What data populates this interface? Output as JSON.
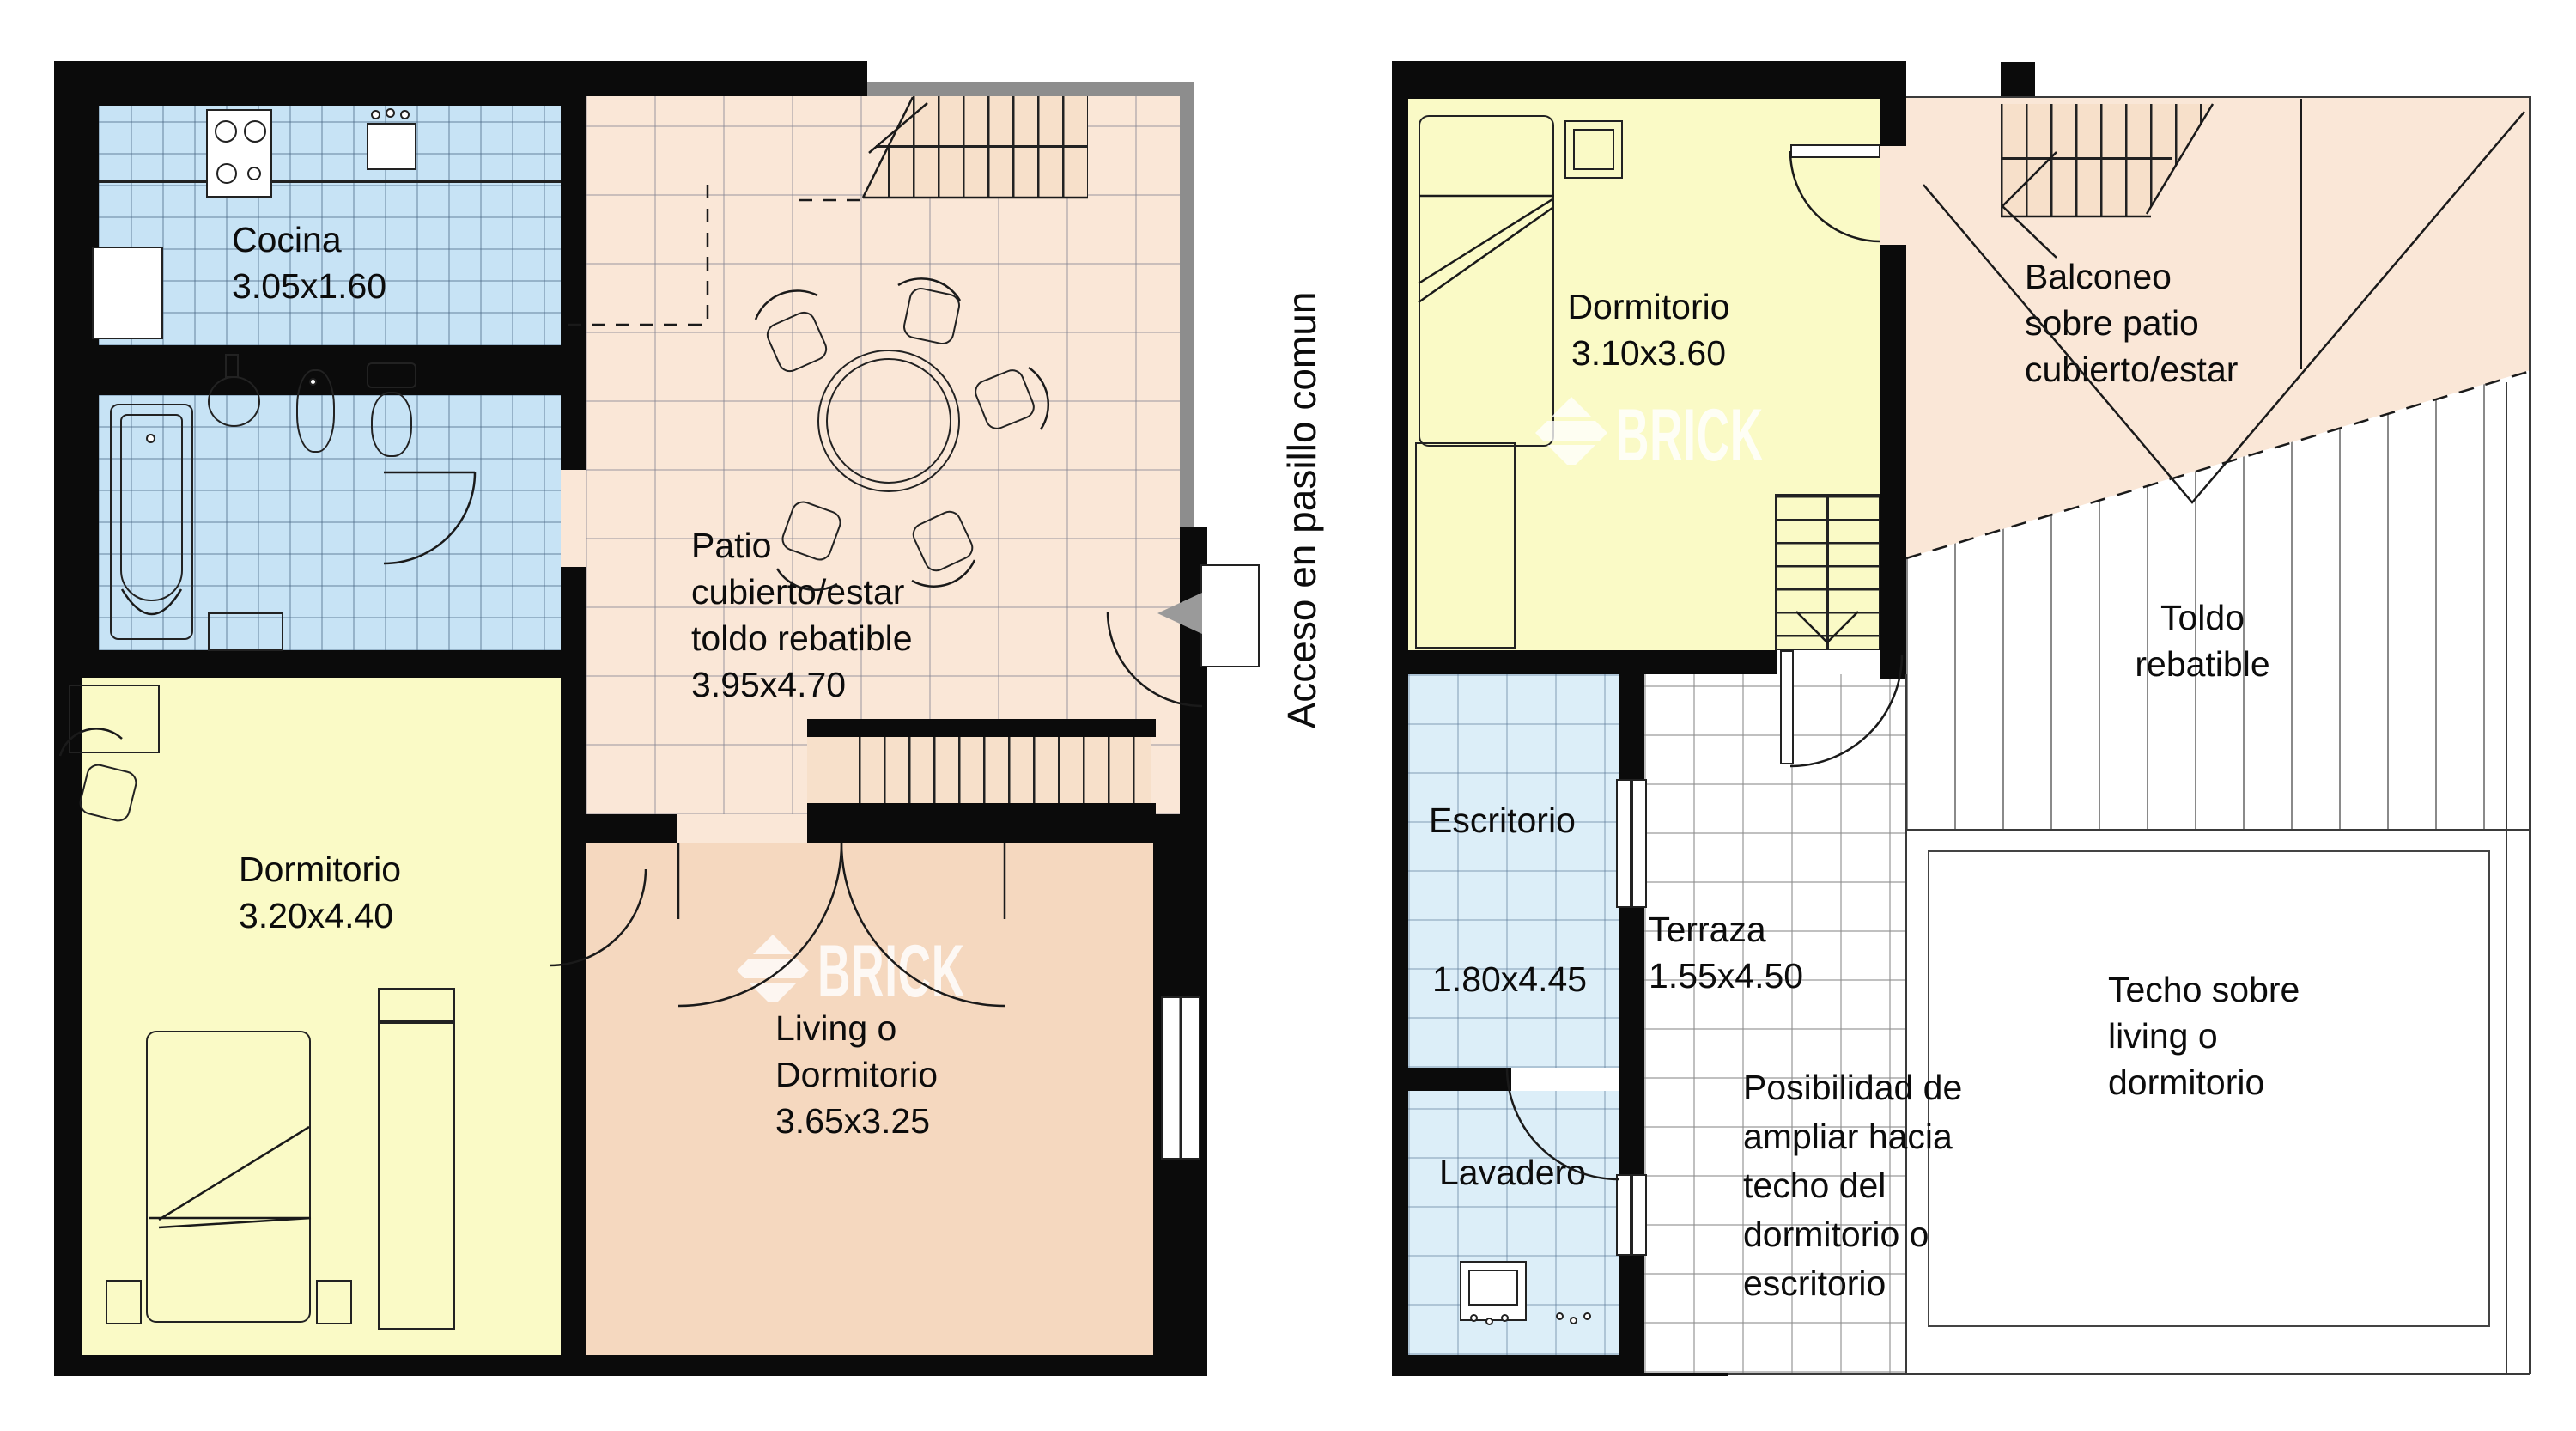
{
  "plans": {
    "left": {
      "rooms": {
        "cocina": {
          "name": "Cocina",
          "dims": "3.05x1.60"
        },
        "patio": {
          "line1": "Patio",
          "line2": "cubierto/estar",
          "line3": "toldo rebatible",
          "dims": "3.95x4.70"
        },
        "dormitorio": {
          "name": "Dormitorio",
          "dims": "3.20x4.40"
        },
        "living": {
          "line1": "Living o",
          "line2": "Dormitorio",
          "dims": "3.65x3.25"
        }
      },
      "annotations": {
        "acceso": "Acceso en pasillo comun"
      }
    },
    "right": {
      "rooms": {
        "dormitorio": {
          "name": "Dormitorio",
          "dims": "3.10x3.60"
        },
        "balconeo": {
          "line1": "Balconeo",
          "line2": "sobre patio",
          "line3": "cubierto/estar"
        },
        "toldo": {
          "line1": "Toldo",
          "line2": "rebatible"
        },
        "escritorio": {
          "name": "Escritorio",
          "dims": "1.80x4.45"
        },
        "terraza": {
          "name": "Terraza",
          "dims": "1.55x4.50"
        },
        "lavadero": {
          "name": "Lavadero"
        },
        "techo": {
          "line1": "Techo sobre",
          "line2": "living o",
          "line3": "dormitorio"
        }
      },
      "annotations": {
        "posibilidad": {
          "line1": "Posibilidad de",
          "line2": "ampliar hacia",
          "line3": "techo del",
          "line4": "dormitorio o",
          "line5": "escritorio"
        }
      }
    }
  },
  "watermark": {
    "brand": "BRICK"
  },
  "colors": {
    "wall_black": "#0b0b0b",
    "bedroom_yellow": "#fafac6",
    "wet_area_blue": "#c7e3f5",
    "service_blue": "#dceef8",
    "patio_peach": "#fae7d7",
    "living_peach": "#f5d8bf",
    "stair_peach": "#f7e0ca",
    "gray_wall": "#8d8d8d",
    "watermark_white": "#ffffff"
  }
}
